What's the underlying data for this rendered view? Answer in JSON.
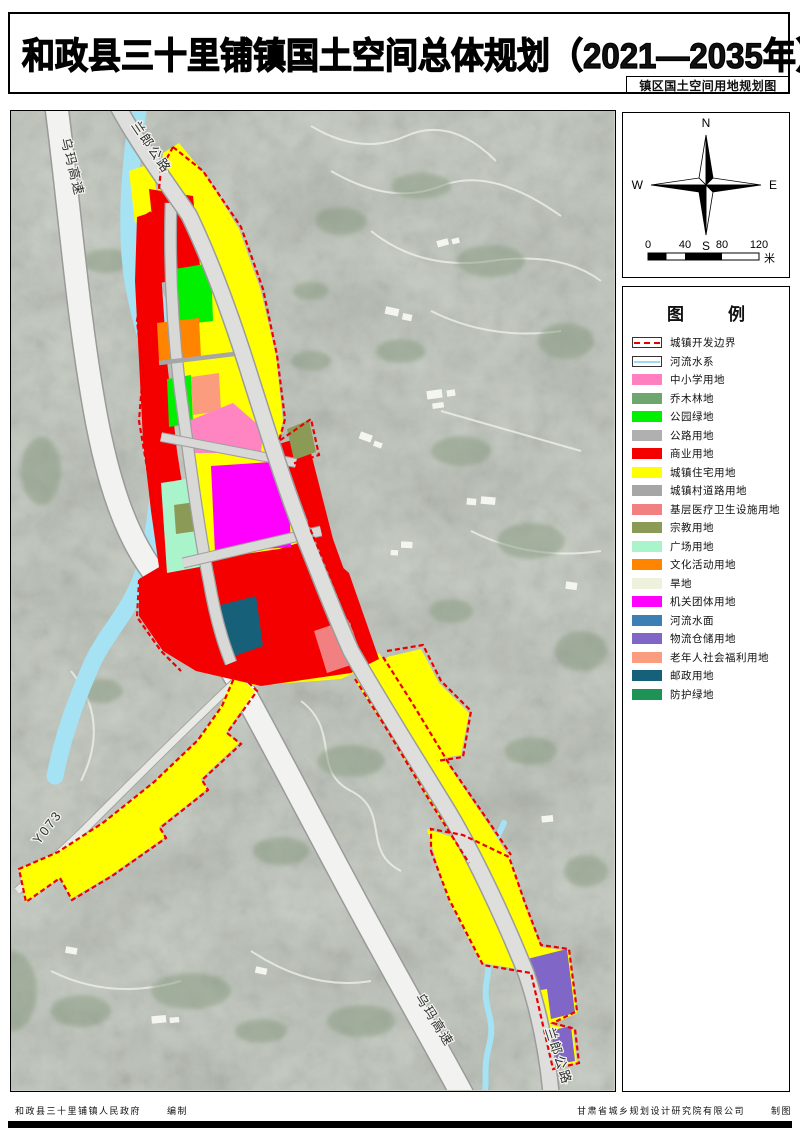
{
  "header": {
    "title": "和政县三十里铺镇国土空间总体规划（2021—2035年）",
    "subtitle": "镇区国土空间用地规划图"
  },
  "map": {
    "road_labels": [
      {
        "text": "乌玛高速",
        "position": "top-left"
      },
      {
        "text": "兰郎公路",
        "position": "top"
      },
      {
        "text": "Y073",
        "position": "left"
      },
      {
        "text": "乌玛高速",
        "position": "bottom-right"
      },
      {
        "text": "兰郎公路",
        "position": "bottom-right-edge"
      }
    ]
  },
  "compass": {
    "n": "N",
    "e": "E",
    "s": "S",
    "w": "W"
  },
  "scale_bar": {
    "ticks": [
      "0",
      "40",
      "80",
      "120"
    ],
    "unit": "米"
  },
  "legend": {
    "title_chars": [
      "图",
      "例"
    ],
    "items": [
      {
        "label": "城镇开发边界",
        "type": "boundary",
        "color": "#e60000"
      },
      {
        "label": "河流水系",
        "type": "river-line",
        "color": "#9fd9f0"
      },
      {
        "label": "中小学用地",
        "type": "fill",
        "color": "#ff7fc0"
      },
      {
        "label": "乔木林地",
        "type": "fill",
        "color": "#6fa66f"
      },
      {
        "label": "公园绿地",
        "type": "fill",
        "color": "#00f000"
      },
      {
        "label": "公路用地",
        "type": "fill",
        "color": "#b0b0b0"
      },
      {
        "label": "商业用地",
        "type": "fill",
        "color": "#f50000"
      },
      {
        "label": "城镇住宅用地",
        "type": "fill",
        "color": "#ffff00"
      },
      {
        "label": "城镇村道路用地",
        "type": "fill",
        "color": "#a6a6a6"
      },
      {
        "label": "基层医疗卫生设施用地",
        "type": "fill",
        "color": "#f28080"
      },
      {
        "label": "宗教用地",
        "type": "fill",
        "color": "#8b9b55"
      },
      {
        "label": "广场用地",
        "type": "fill",
        "color": "#aaf4cb"
      },
      {
        "label": "文化活动用地",
        "type": "fill",
        "color": "#ff8400"
      },
      {
        "label": "旱地",
        "type": "fill",
        "color": "#eef1db"
      },
      {
        "label": "机关团体用地",
        "type": "fill",
        "color": "#ff00ff"
      },
      {
        "label": "河流水面",
        "type": "fill",
        "color": "#3b7fb5"
      },
      {
        "label": "物流仓储用地",
        "type": "fill",
        "color": "#8066c6"
      },
      {
        "label": "老年人社会福利用地",
        "type": "fill",
        "color": "#fa9c7d"
      },
      {
        "label": "邮政用地",
        "type": "fill",
        "color": "#17607a"
      },
      {
        "label": "防护绿地",
        "type": "fill",
        "color": "#1e9356"
      }
    ]
  },
  "footer": {
    "left_org": "和政县三十里铺镇人民政府",
    "left_role": "编制",
    "right_org": "甘肃省城乡规划设计研究院有限公司",
    "right_role": "制图"
  }
}
